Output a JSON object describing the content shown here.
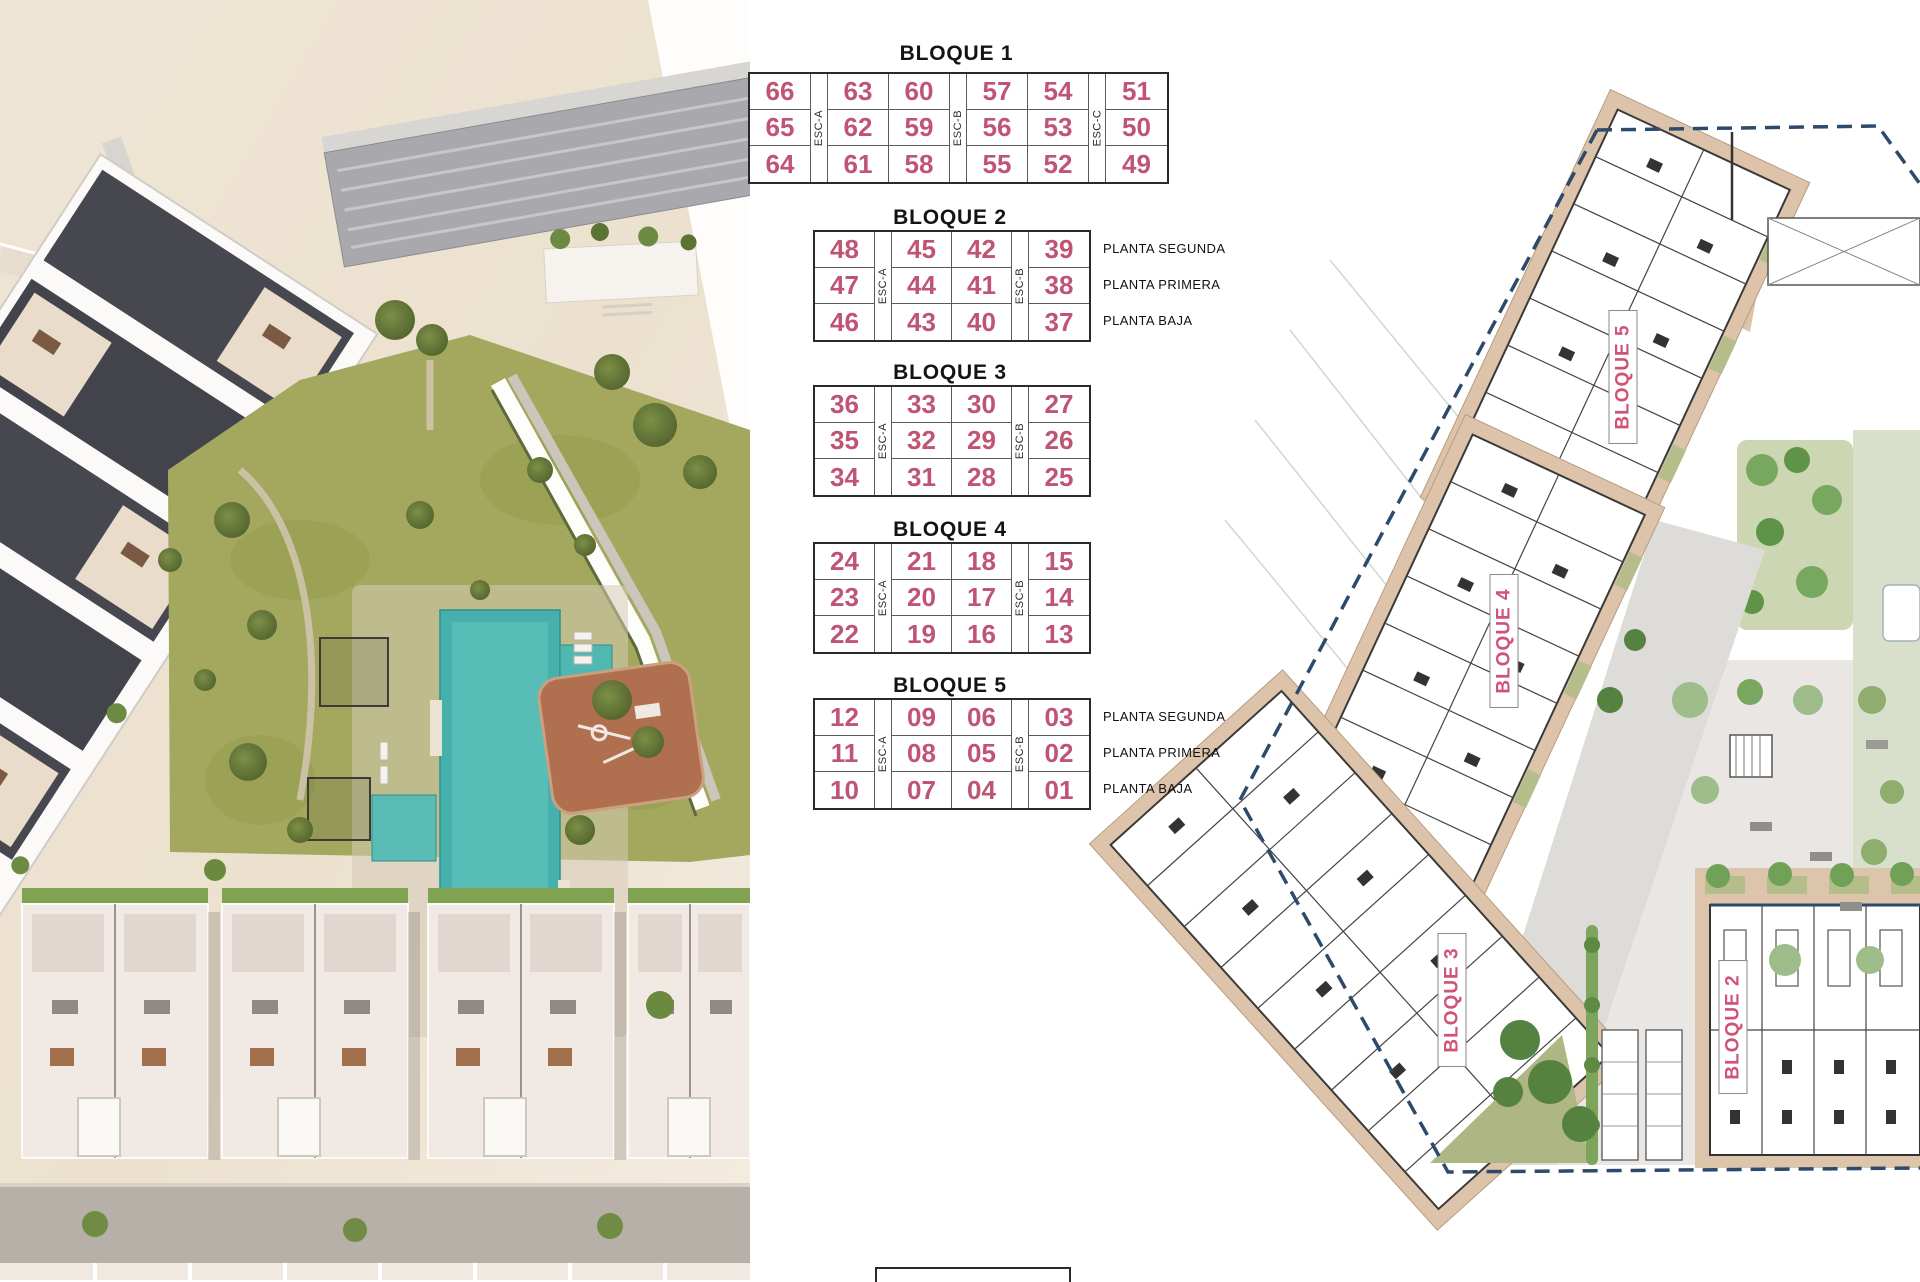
{
  "tables": [
    {
      "title": "BLOQUE 1",
      "stairs": [
        "ESC-A",
        "ESC-B",
        "ESC-C"
      ],
      "rows": [
        [
          "66",
          "63",
          "60",
          "57",
          "54",
          "51"
        ],
        [
          "65",
          "62",
          "59",
          "56",
          "53",
          "50"
        ],
        [
          "64",
          "61",
          "58",
          "55",
          "52",
          "49"
        ]
      ],
      "floors": []
    },
    {
      "title": "BLOQUE 2",
      "stairs": [
        "ESC-A",
        "ESC-B"
      ],
      "rows": [
        [
          "48",
          "45",
          "42",
          "39"
        ],
        [
          "47",
          "44",
          "41",
          "38"
        ],
        [
          "46",
          "43",
          "40",
          "37"
        ]
      ],
      "floors": [
        "PLANTA SEGUNDA",
        "PLANTA PRIMERA",
        "PLANTA BAJA"
      ]
    },
    {
      "title": "BLOQUE 3",
      "stairs": [
        "ESC-A",
        "ESC-B"
      ],
      "rows": [
        [
          "36",
          "33",
          "30",
          "27"
        ],
        [
          "35",
          "32",
          "29",
          "26"
        ],
        [
          "34",
          "31",
          "28",
          "25"
        ]
      ],
      "floors": []
    },
    {
      "title": "BLOQUE 4",
      "stairs": [
        "ESC-A",
        "ESC-B"
      ],
      "rows": [
        [
          "24",
          "21",
          "18",
          "15"
        ],
        [
          "23",
          "20",
          "17",
          "14"
        ],
        [
          "22",
          "19",
          "16",
          "13"
        ]
      ],
      "floors": []
    },
    {
      "title": "BLOQUE 5",
      "stairs": [
        "ESC-A",
        "ESC-B"
      ],
      "rows": [
        [
          "12",
          "09",
          "06",
          "03"
        ],
        [
          "11",
          "08",
          "05",
          "02"
        ],
        [
          "10",
          "07",
          "04",
          "01"
        ]
      ],
      "floors": [
        "PLANTA SEGUNDA",
        "PLANTA PRIMERA",
        "PLANTA BAJA"
      ]
    }
  ],
  "plan": {
    "labels": [
      "BLOQUE 5",
      "BLOQUE 4",
      "BLOQUE 3",
      "BLOQUE 2"
    ]
  },
  "colors": {
    "unit_number_pink": "#bf5474",
    "plan_label_pink": "#cf5377",
    "boundary_navy": "#2d4a6d",
    "pool_teal": "#45b0ac",
    "lawn_green": "#a3a85e",
    "building_tan": "#dcc3a9"
  }
}
